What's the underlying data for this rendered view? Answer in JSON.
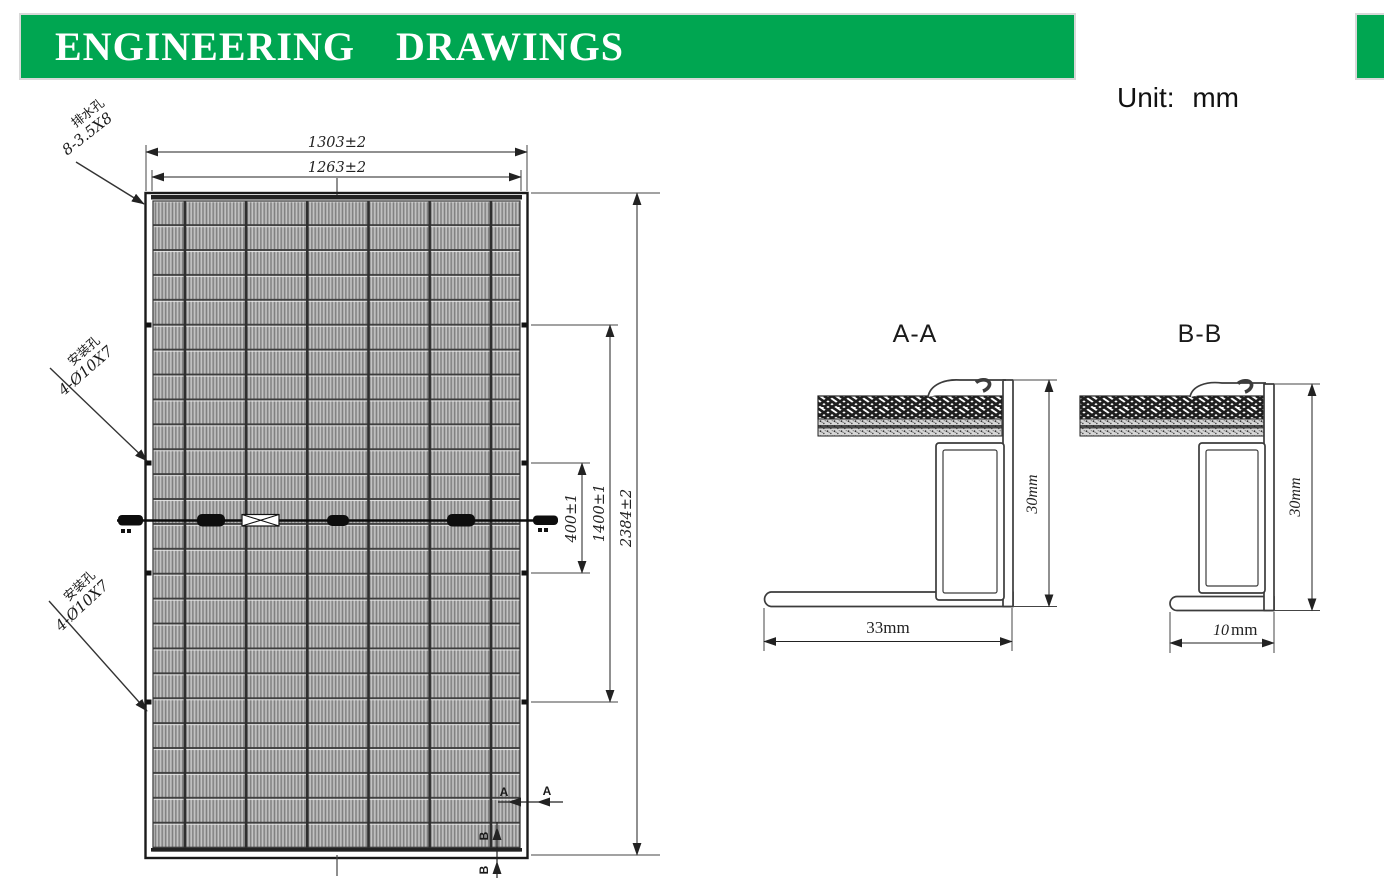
{
  "header": {
    "title": "ENGINEERING DRAWINGS",
    "unit_label": "Unit: mm",
    "accent_green": "#00A651"
  },
  "panel": {
    "dim_width_outer": "1303±2",
    "dim_width_inner": "1263±2",
    "dim_height": "2384±2",
    "dim_mount_outer": "1400±1",
    "dim_mount_inner": "400±1",
    "drain_label_cn": "排水孔",
    "drain_label_spec": "8-3.5X8",
    "mount1_label_cn": "安装孔",
    "mount1_label_spec": "4-Ø10X7",
    "mount2_label_cn": "安装孔",
    "mount2_label_spec": "4-Ø10X7",
    "mark_a_inner": "A",
    "mark_a_outer": "A",
    "mark_b_inner": "B",
    "mark_b_outer": "B"
  },
  "sections": {
    "aa": {
      "title": "A-A",
      "height_label": "30mm",
      "width_label": "33mm"
    },
    "bb": {
      "title": "B-B",
      "height_label": "30mm",
      "width_value": "10",
      "width_unit": "mm"
    }
  }
}
